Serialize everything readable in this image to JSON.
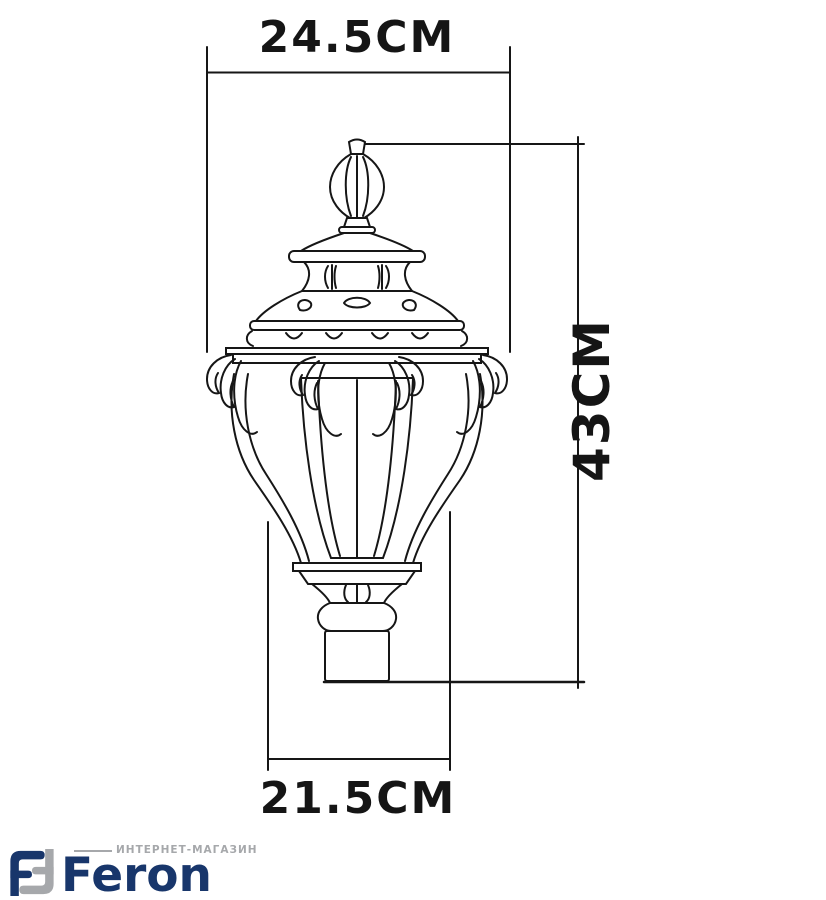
{
  "page": {
    "background": "#ffffff"
  },
  "diagram": {
    "subject": "ornate-garden-post-lantern-technical-drawing",
    "line_color": "#161616",
    "dim_top": "24.5CM",
    "dim_height": "43CM",
    "dim_bottom": "21.5CM"
  },
  "footer": {
    "tagline": "ИНТЕРНЕТ-МАГАЗИН",
    "brand": "Feron",
    "brand_color": "#18366b",
    "tagline_color": "#a6a8ab",
    "logo_navy": "#18366b",
    "logo_gray": "#a6a8ab"
  }
}
